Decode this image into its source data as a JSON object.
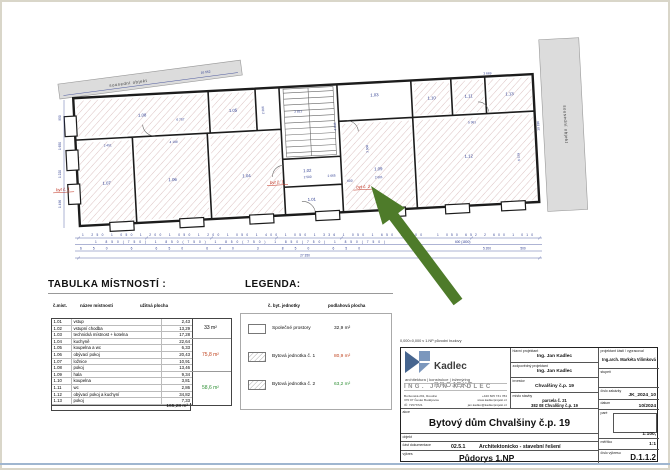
{
  "plan": {
    "neighbor_label": "sousední objekt",
    "neighbor_right_label": "sousední objekt",
    "flat1_label": "byt č. 1",
    "flat2_label": "byt č. 2",
    "rooms": {
      "r01": "1.01",
      "r02": "1.02",
      "r03": "1.03",
      "r04": "1.04",
      "r05": "1.05",
      "r06": "1.06",
      "r07": "1.07",
      "r08": "1.08",
      "r09": "1.09",
      "r10": "1.10",
      "r11": "1.11",
      "r12": "1.12",
      "r13": "1.13"
    },
    "dims": {
      "top": "16 552",
      "right": "10 196",
      "row1": "1 250 1 050 1 200 1 050 1 200 1 050 1 400 1 050 1 336 1 050 1 650 1 200",
      "row1r": "1 050 652 2 600 1 010",
      "row2": "1 850(750) 1 850(750) 1 850(750) 1 850(750) 1 850(750)",
      "row2r": "600 (1800)",
      "row3": "650 6 650 640 3 850 650",
      "row3r1": "5 200",
      "row3r2": "500",
      "total": "27 350",
      "left1": "950",
      "left2": "1 650",
      "left3": "1 220",
      "left4": "1 496",
      "i_6757": "6 757",
      "i_2451": "2 451",
      "i_4198": "4 198",
      "i_2500": "2 500",
      "i_2665": "2 665",
      "i_3821": "3 821",
      "i_4844": "4 844",
      "i_5361": "5 361",
      "i_2601": "2 601",
      "i_3669": "3 669",
      "i_6379": "6 379",
      "i_600": "600",
      "i_2266": "2 266",
      "i_3500": "3 500"
    }
  },
  "table": {
    "title": "TABULKA MÍSTNOSTÍ :",
    "headers": {
      "no": "č.míst.",
      "name": "název místnosti",
      "area": "užitná plocha"
    },
    "rows": [
      [
        "1.01",
        "vstup",
        "2,43"
      ],
      [
        "1.02",
        "vstupní chodba",
        "13,29"
      ],
      [
        "1.03",
        "technická místnost + kotelna",
        "17,28"
      ],
      [
        "1.04",
        "kuchyně",
        "22,64"
      ],
      [
        "1.05",
        "koupelna a wc",
        "6,33"
      ],
      [
        "1.06",
        "obývací pokoj",
        "20,43"
      ],
      [
        "1.07",
        "ložnice",
        "10,91"
      ],
      [
        "1.08",
        "pokoj",
        "13,46"
      ],
      [
        "1.09",
        "hala",
        "9,34"
      ],
      [
        "1.10",
        "koupelna",
        "3,81"
      ],
      [
        "1.11",
        "wc",
        "2,86"
      ],
      [
        "1.12",
        "obývací pokoj a kuchyní",
        "34,82"
      ],
      [
        "1.13",
        "pokoj",
        "7,33"
      ]
    ],
    "total": "165,28 m²",
    "groups": [
      {
        "area": "33 m²"
      },
      {
        "area": "75,8 m²"
      },
      {
        "area": "58,6 m²"
      }
    ]
  },
  "legend": {
    "title": "LEGENDA:",
    "headers": {
      "unit": "č. byt. jednotky",
      "area": "podlahová plocha"
    },
    "rows": [
      {
        "name": "Společné prostory",
        "area": "32,9 m²"
      },
      {
        "name": "Bytová jednotka č. 1",
        "area": "80,9 m²"
      },
      {
        "name": "Bytová jednotka č. 2",
        "area": "63,2 m²"
      }
    ]
  },
  "titleblock": {
    "note": "0,000=0,000 v 1.NP původní budovy",
    "logo": {
      "brand": "Kadlec",
      "brand2": "PROJEKT",
      "tagline": "architektura | konstrukce | inženýring",
      "person": "ING. JAN KADLEC",
      "contacts": {
        "addr1": "Boršovská 291, Roudné",
        "phone": "+420 605 731 784",
        "addr2": "370 07 České Budějovice",
        "web": "www.kadlecprojekt.cz",
        "addr3": "IČ: 71573721",
        "email": "jan.kadlec@kadlecprojekt.cz"
      }
    },
    "fields": {
      "hlavni": {
        "label": "hlavní projektant",
        "value": "Ing. Jan Kadlec"
      },
      "zodpovedny": {
        "label": "zodpovědný projektant",
        "value": "Ing. Jan Kadlec"
      },
      "investor": {
        "label": "investor",
        "value": "Chvalšiny č.p. 19"
      },
      "misto": {
        "label": "místo stavby",
        "value1": "parcela č. 21",
        "value2": "382 08 Chvalšiny č.p. 19"
      },
      "projektant_casti": {
        "label": "projektant části / vypracoval",
        "value": "Ing.arch. Markéta Vilímková"
      },
      "stupen": {
        "label": "stupeň",
        "value": ""
      },
      "cislo_zakazky": {
        "label": "číslo zakázky",
        "value": "JK_2024_10"
      },
      "datum": {
        "label": "datum",
        "value": "10/2024"
      },
      "pare": {
        "label": "paré"
      },
      "meritko": {
        "label": "měřítko",
        "value1": "1:100,",
        "value2": "1:1"
      },
      "cislo_vykresu": {
        "label": "číslo výkresu",
        "value": "D.1.1.2"
      },
      "akce": {
        "label": "akce",
        "value": "Bytový dům Chvalšiny č.p. 19"
      },
      "objekt": {
        "label": "objekt",
        "value": ""
      },
      "cast_dok": {
        "label": "část dokumentace",
        "num": "02.5.1",
        "value": "Architektonicko - stavební řešení"
      },
      "vykres": {
        "label": "výkres",
        "value": "Půdorys 1.NP"
      }
    }
  }
}
